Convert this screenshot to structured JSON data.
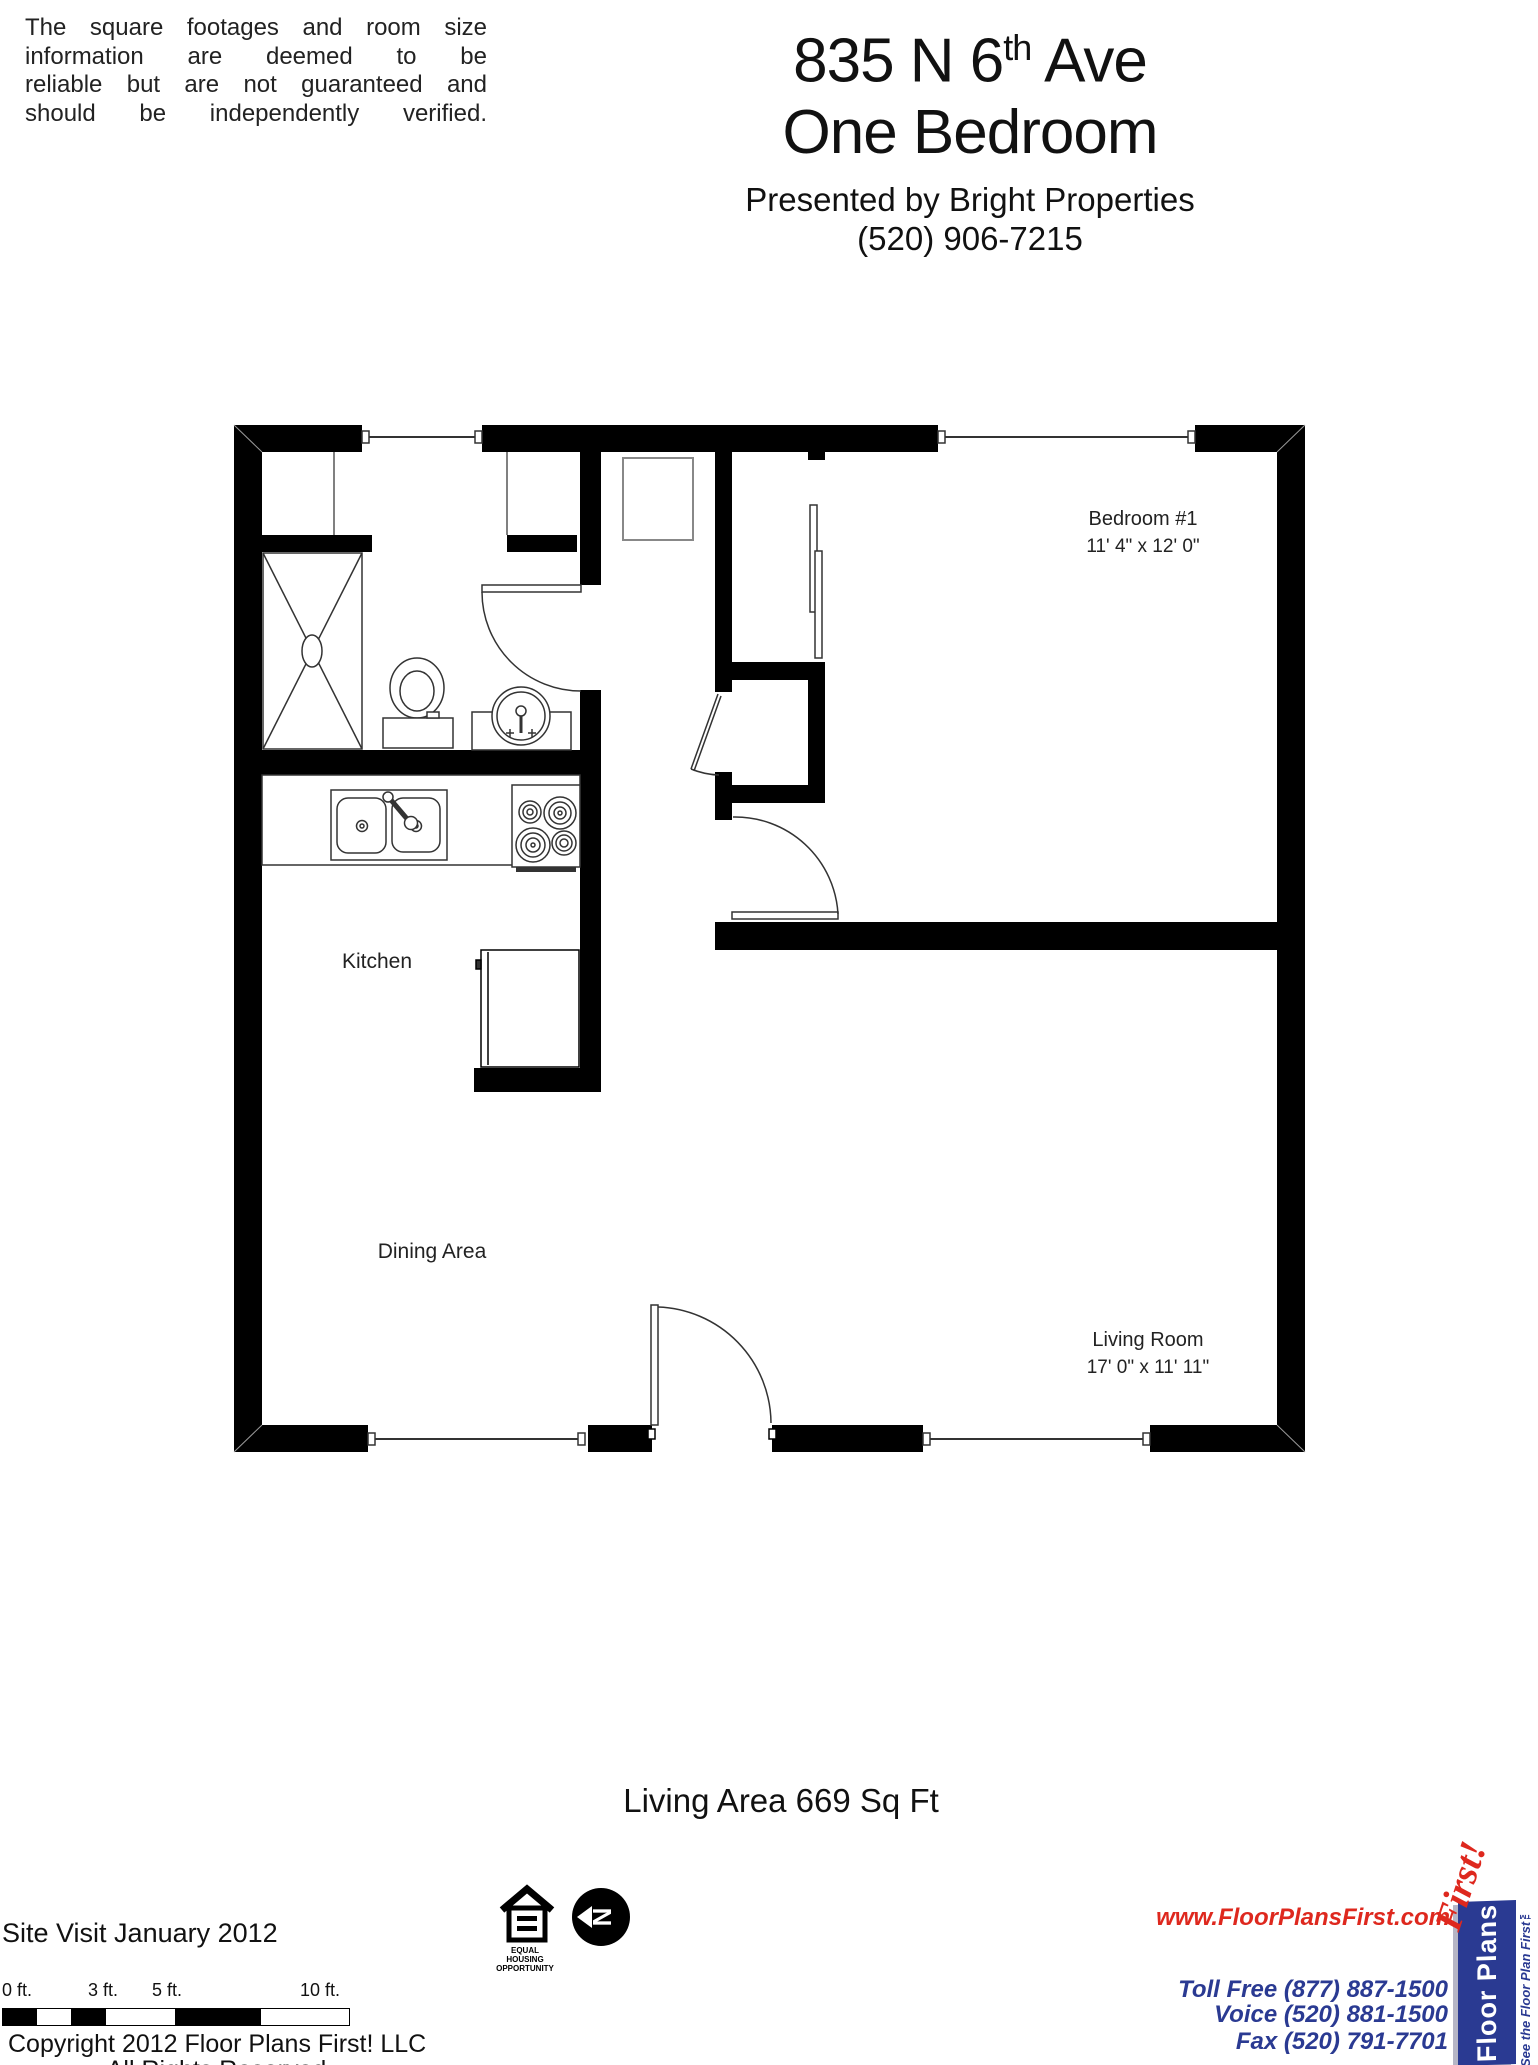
{
  "disclaimer": {
    "lines": [
      "The square footages and room size",
      "information are deemed to be",
      "reliable but are not guaranteed and",
      "should be independently verified."
    ]
  },
  "header": {
    "address_pre": "835 N 6",
    "address_sup": "th",
    "address_post": " Ave",
    "subtitle": "One Bedroom",
    "presented_by": "Presented by Bright Properties",
    "phone": "(520) 906-7215"
  },
  "plan": {
    "rooms": {
      "bedroom": {
        "name": "Bedroom #1",
        "dims": "11' 4\" x 12' 0\""
      },
      "living": {
        "name": "Living Room",
        "dims": "17' 0\" x 11' 11\""
      },
      "kitchen": {
        "name": "Kitchen"
      },
      "dining": {
        "name": "Dining Area"
      }
    }
  },
  "footer": {
    "living_area": "Living Area 669 Sq Ft",
    "site_visit": "Site Visit January 2012",
    "scale_labels": [
      "0 ft.",
      "3 ft.",
      "5 ft.",
      "10 ft."
    ],
    "eho_caption": [
      "EQUAL",
      "HOUSING",
      "OPPORTUNITY"
    ],
    "north_letter": "N",
    "website": "www.FloorPlansFirst.com",
    "toll_free": "Toll Free (877) 887-1500",
    "voice": "Voice (520) 881-1500",
    "fax": "Fax (520) 791-7701",
    "copyright_line1": "Copyright 2012 Floor Plans First! LLC",
    "copyright_line2": "All Rights Reserved.",
    "logo": {
      "name_part1": "Floor Plans",
      "name_part2": "First!",
      "tagline": "See the Floor Plan First™"
    }
  },
  "colors": {
    "accent_red": "#de281e",
    "accent_navy": "#2a3a92",
    "wall_black": "#000000"
  }
}
